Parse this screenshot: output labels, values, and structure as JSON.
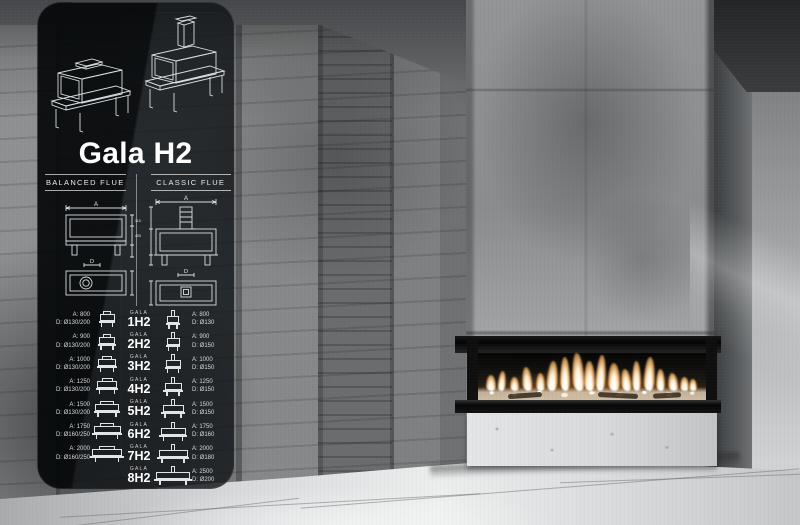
{
  "panel": {
    "title": "Gala H2",
    "columns": {
      "balanced": "BALANCED FLUE",
      "classic": "CLASSIC FLUE"
    },
    "diagram": {
      "width_label": "A",
      "flue_label": "D",
      "balanced_dims": [
        "110",
        "400"
      ]
    },
    "brand": "GALA",
    "models": [
      {
        "name": "1H2",
        "balanced_a": "A: 800",
        "balanced_d": "D: Ø130/200",
        "classic_a": "A: 800",
        "classic_d": "D: Ø130"
      },
      {
        "name": "2H2",
        "balanced_a": "A: 900",
        "balanced_d": "D: Ø130/200",
        "classic_a": "A: 900",
        "classic_d": "D: Ø150"
      },
      {
        "name": "3H2",
        "balanced_a": "A: 1000",
        "balanced_d": "D: Ø130/200",
        "classic_a": "A: 1000",
        "classic_d": "D: Ø150"
      },
      {
        "name": "4H2",
        "balanced_a": "A: 1250",
        "balanced_d": "D: Ø130/200",
        "classic_a": "A: 1250",
        "classic_d": "D: Ø150"
      },
      {
        "name": "5H2",
        "balanced_a": "A: 1500",
        "balanced_d": "D: Ø130/200",
        "classic_a": "A: 1500",
        "classic_d": "D: Ø150"
      },
      {
        "name": "6H2",
        "balanced_a": "A: 1750",
        "balanced_d": "D: Ø160/250",
        "classic_a": "A: 1750",
        "classic_d": "D: Ø160"
      },
      {
        "name": "7H2",
        "balanced_a": "A: 2000",
        "balanced_d": "D: Ø160/250",
        "classic_a": "A: 2000",
        "classic_d": "D: Ø180"
      },
      {
        "name": "8H2",
        "balanced_a": "",
        "balanced_d": "",
        "classic_a": "A: 2500",
        "classic_d": "D: Ø200"
      }
    ]
  },
  "colors": {
    "flame_accent": "#ff9a4a",
    "ember_warm": "#ffe9c4",
    "panel_glass": "#0a0d0f",
    "concrete_light": "#d9dadc",
    "concrete_dark": "#4a4c4e"
  }
}
